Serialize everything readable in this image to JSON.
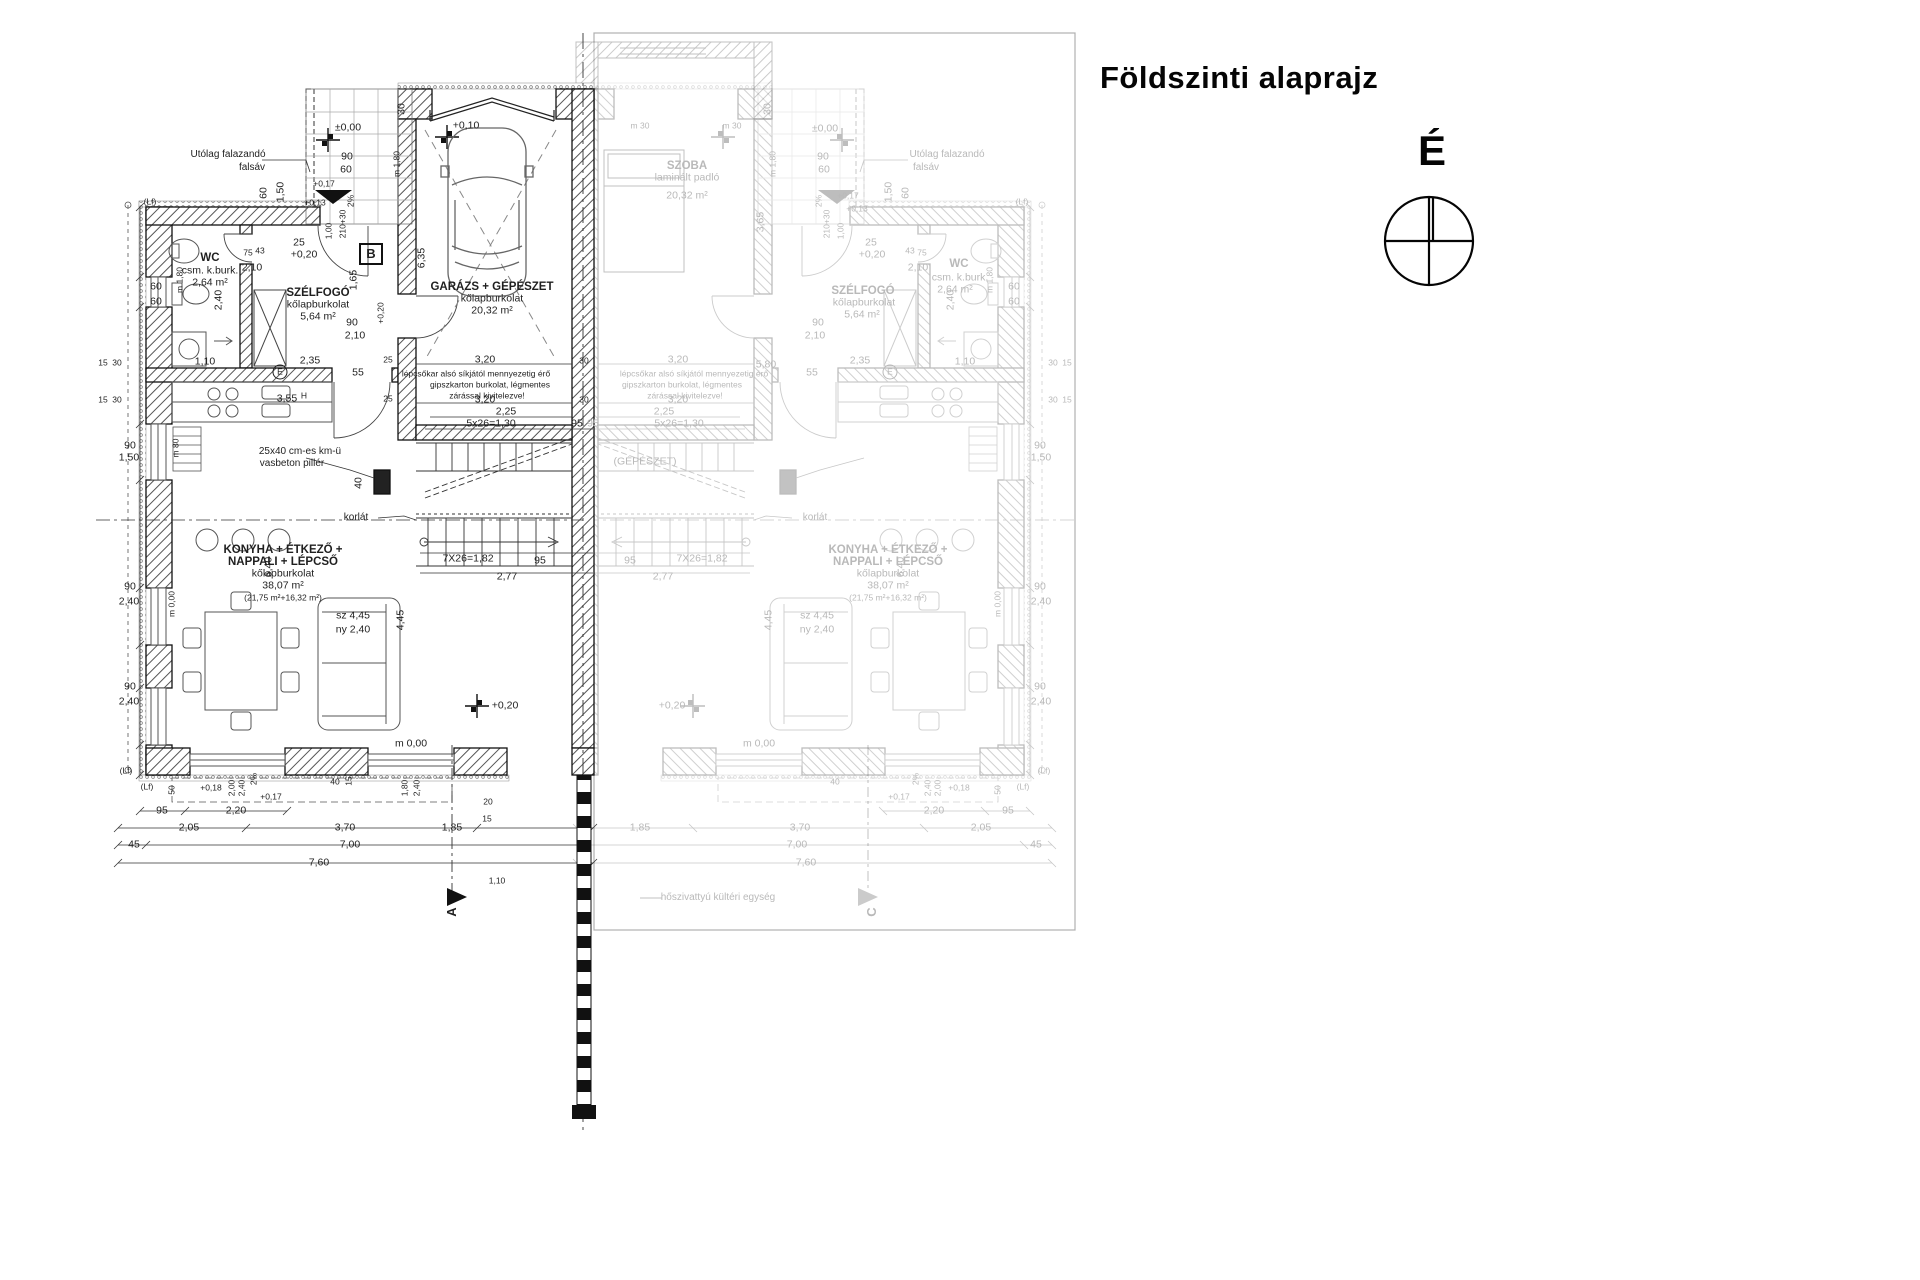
{
  "title": "Földszinti alaprajz",
  "north": {
    "label": "É"
  },
  "colors": {
    "ink": "#1f1f1f",
    "faded": "#b9b9b9",
    "paper": "#ffffff"
  },
  "rooms_left_unit": [
    {
      "name": "WC",
      "finish": "csm. k.burk.",
      "area": "2,64 m²"
    },
    {
      "name": "SZÉLFOGÓ",
      "finish": "kőlapburkolat",
      "area": "5,64 m²"
    },
    {
      "name": "GARÁZS + GÉPÉSZET",
      "finish": "kőlapburkolat",
      "area": "20,32 m²"
    },
    {
      "name": "KONYHA + ÉTKEZŐ + NAPPALI + LÉPCSŐ",
      "finish": "kőlapburkolat",
      "area": "38,07 m² (21,75 m²+16,32 m²)"
    }
  ],
  "rooms_right_unit_faded": [
    {
      "name": "SZOBA",
      "finish": "laminált padló",
      "area": "20,32 m²"
    },
    {
      "name": "WC",
      "finish": "csm. k.burk.",
      "area": "2,64 m²"
    },
    {
      "name": "SZÉLFOGÓ",
      "finish": "kőlapburkolat",
      "area": "5,64 m²"
    },
    {
      "name": "KONYHA + ÉTKEZŐ + NAPPALI + LÉPCSŐ",
      "finish": "kőlapburkolat",
      "area": "38,07 m² (21,75 m²+16,32 m²)"
    }
  ],
  "annotations": [
    {
      "n": "room-label-wc",
      "t": "WC",
      "x": 210,
      "y": 258,
      "c": "rm"
    },
    {
      "n": "room-finish-wc",
      "t": "csm. k.burk.",
      "x": 210,
      "y": 271,
      "c": "sub"
    },
    {
      "n": "room-area-wc",
      "t": "2,64 m²",
      "x": 210,
      "y": 283,
      "c": "sub"
    },
    {
      "n": "room-label-szelfogo",
      "t": "SZÉLFOGÓ",
      "x": 318,
      "y": 293,
      "c": "rm"
    },
    {
      "n": "room-finish-szelfogo",
      "t": "kőlapburkolat",
      "x": 318,
      "y": 305,
      "c": "sub"
    },
    {
      "n": "room-area-szelfogo",
      "t": "5,64 m²",
      "x": 318,
      "y": 317,
      "c": "sub"
    },
    {
      "n": "room-label-garazs",
      "t": "GARÁZS + GÉPÉSZET",
      "x": 492,
      "y": 287,
      "c": "rm"
    },
    {
      "n": "room-finish-garazs",
      "t": "kőlapburkolat",
      "x": 492,
      "y": 299,
      "c": "sub"
    },
    {
      "n": "room-area-garazs",
      "t": "20,32 m²",
      "x": 492,
      "y": 311,
      "c": "sub"
    },
    {
      "n": "room-label-konyha",
      "t": "KONYHA + ÉTKEZŐ +",
      "x": 283,
      "y": 550,
      "c": "rm"
    },
    {
      "n": "room-label-konyha2",
      "t": "NAPPALI + LÉPCSŐ",
      "x": 283,
      "y": 562,
      "c": "rm"
    },
    {
      "n": "room-finish-konyha",
      "t": "kőlapburkolat",
      "x": 283,
      "y": 574,
      "c": "sub"
    },
    {
      "n": "room-area-konyha",
      "t": "38,07 m²",
      "x": 283,
      "y": 586,
      "c": "sub"
    },
    {
      "n": "room-area-konyha2",
      "t": "(21,75 m²+16,32 m²)",
      "x": 283,
      "y": 598,
      "c": "tiny"
    },
    {
      "n": "note-falsav-1",
      "t": "Utólag falazandó",
      "x": 228,
      "y": 155,
      "c": "note"
    },
    {
      "n": "note-falsav-2",
      "t": "falsáv",
      "x": 252,
      "y": 168,
      "c": "note"
    },
    {
      "n": "note-pillar-1",
      "t": "25x40 cm-es km-ü",
      "x": 300,
      "y": 452,
      "c": "note"
    },
    {
      "n": "note-pillar-2",
      "t": "vasbeton pillér",
      "x": 292,
      "y": 464,
      "c": "note"
    },
    {
      "n": "note-gipszkarton-1",
      "t": "lépcsőkar alsó síkjától mennyezetig érő",
      "x": 476,
      "y": 374,
      "c": "tiny"
    },
    {
      "n": "note-gipszkarton-2",
      "t": "gipszkarton burkolat, légmentes",
      "x": 490,
      "y": 385,
      "c": "tiny"
    },
    {
      "n": "note-gipszkarton-3",
      "t": "zárással kivitelezve!",
      "x": 487,
      "y": 396,
      "c": "tiny"
    },
    {
      "n": "note-korlat",
      "t": "korlát",
      "x": 356,
      "y": 518,
      "c": "note"
    },
    {
      "t": "3,55",
      "x": 287,
      "y": 399
    },
    {
      "t": "H",
      "x": 304,
      "y": 396,
      "c": "tiny"
    },
    {
      "n": "level-porch",
      "t": "±0,00",
      "x": 348,
      "y": 128
    },
    {
      "n": "level-garage",
      "t": "+0,10",
      "x": 466,
      "y": 126
    },
    {
      "n": "level-szelfogo",
      "t": "+0,20",
      "x": 304,
      "y": 255
    },
    {
      "n": "level-living",
      "t": "+0,20",
      "x": 505,
      "y": 706
    },
    {
      "n": "level-terrace",
      "t": "m 0,00",
      "x": 411,
      "y": 744
    },
    {
      "t": "90",
      "x": 347,
      "y": 157
    },
    {
      "t": "60",
      "x": 346,
      "y": 170
    },
    {
      "t": "(Lf)",
      "x": 150,
      "y": 202,
      "c": "tiny"
    },
    {
      "t": "60",
      "x": 264,
      "y": 193,
      "r": -90
    },
    {
      "t": "1,50",
      "x": 281,
      "y": 192,
      "r": -90
    },
    {
      "t": "m 1,80",
      "x": 397,
      "y": 164,
      "r": -90,
      "c": "tiny"
    },
    {
      "t": "30",
      "x": 402,
      "y": 109,
      "r": -90
    },
    {
      "t": "2%",
      "x": 351,
      "y": 201,
      "r": -90,
      "c": "tiny"
    },
    {
      "t": "210+30",
      "x": 343,
      "y": 224,
      "r": -90,
      "c": "tiny"
    },
    {
      "t": "1,00",
      "x": 329,
      "y": 231,
      "r": -90,
      "c": "tiny"
    },
    {
      "t": "25",
      "x": 299,
      "y": 243
    },
    {
      "t": "+0,17",
      "x": 324,
      "y": 184,
      "c": "tiny"
    },
    {
      "t": "+0,13",
      "x": 315,
      "y": 203,
      "c": "tiny"
    },
    {
      "t": "60",
      "x": 156,
      "y": 287
    },
    {
      "t": "60",
      "x": 156,
      "y": 302
    },
    {
      "t": "75",
      "x": 248,
      "y": 253,
      "c": "tiny"
    },
    {
      "t": "43",
      "x": 260,
      "y": 251,
      "c": "tiny"
    },
    {
      "t": "2,10",
      "x": 252,
      "y": 268
    },
    {
      "t": "1,65",
      "x": 354,
      "y": 280,
      "r": -90
    },
    {
      "t": "2,40",
      "x": 219,
      "y": 300,
      "r": -90
    },
    {
      "t": "m 1,80",
      "x": 180,
      "y": 280,
      "r": -90,
      "c": "tiny"
    },
    {
      "t": "90",
      "x": 352,
      "y": 323
    },
    {
      "t": "2,10",
      "x": 355,
      "y": 336
    },
    {
      "t": "55",
      "x": 358,
      "y": 373
    },
    {
      "t": "2,35",
      "x": 310,
      "y": 361
    },
    {
      "t": "1,10",
      "x": 205,
      "y": 362
    },
    {
      "t": "15",
      "x": 103,
      "y": 363,
      "c": "tiny"
    },
    {
      "t": "30",
      "x": 117,
      "y": 363,
      "c": "tiny"
    },
    {
      "t": "15",
      "x": 103,
      "y": 400,
      "c": "tiny"
    },
    {
      "t": "30",
      "x": 117,
      "y": 400,
      "c": "tiny"
    },
    {
      "n": "symbol-e",
      "t": "E",
      "x": 280,
      "y": 372,
      "c": "circ"
    },
    {
      "t": "90",
      "x": 130,
      "y": 446
    },
    {
      "t": "1,50",
      "x": 129,
      "y": 458
    },
    {
      "t": "90",
      "x": 130,
      "y": 587
    },
    {
      "t": "2,40",
      "x": 129,
      "y": 602
    },
    {
      "t": "90",
      "x": 130,
      "y": 687
    },
    {
      "t": "2,40",
      "x": 129,
      "y": 702
    },
    {
      "t": "m 0,00",
      "x": 172,
      "y": 604,
      "r": -90,
      "c": "tiny"
    },
    {
      "t": "m 80",
      "x": 176,
      "y": 448,
      "r": -90,
      "c": "tiny"
    },
    {
      "t": "6,35",
      "x": 422,
      "y": 258,
      "r": -90
    },
    {
      "t": "+0,20",
      "x": 381,
      "y": 313,
      "r": -90,
      "c": "tiny"
    },
    {
      "t": "3,20",
      "x": 485,
      "y": 360
    },
    {
      "t": "3,20",
      "x": 485,
      "y": 400
    },
    {
      "t": "2,25",
      "x": 506,
      "y": 412
    },
    {
      "t": "5x26=1,30",
      "x": 491,
      "y": 424
    },
    {
      "t": "95",
      "x": 577,
      "y": 424
    },
    {
      "t": "7X26=1,82",
      "x": 468,
      "y": 559
    },
    {
      "t": "95",
      "x": 540,
      "y": 561
    },
    {
      "t": "2,77",
      "x": 507,
      "y": 577
    },
    {
      "t": "40",
      "x": 359,
      "y": 483,
      "r": -90
    },
    {
      "t": "6,40",
      "x": 269,
      "y": 567,
      "r": -90
    },
    {
      "t": "sz  4,45",
      "x": 353,
      "y": 616
    },
    {
      "t": "ny  2,40",
      "x": 353,
      "y": 630
    },
    {
      "t": "4,45",
      "x": 401,
      "y": 620,
      "r": -90
    },
    {
      "t": "(Lf)",
      "x": 126,
      "y": 771,
      "c": "tiny"
    },
    {
      "t": "(Lf)",
      "x": 147,
      "y": 787,
      "c": "tiny"
    },
    {
      "t": "50",
      "x": 172,
      "y": 790,
      "r": -90,
      "c": "tiny"
    },
    {
      "t": "+0,18",
      "x": 211,
      "y": 788,
      "c": "tiny"
    },
    {
      "t": "2,00",
      "x": 232,
      "y": 788,
      "r": -90,
      "c": "tiny"
    },
    {
      "t": "2,40",
      "x": 242,
      "y": 788,
      "r": -90,
      "c": "tiny"
    },
    {
      "t": "2%",
      "x": 254,
      "y": 779,
      "r": -90,
      "c": "tiny"
    },
    {
      "t": "+0,17",
      "x": 271,
      "y": 797,
      "c": "tiny"
    },
    {
      "t": "40",
      "x": 335,
      "y": 782,
      "c": "tiny"
    },
    {
      "t": "15",
      "x": 349,
      "y": 781,
      "r": -90,
      "c": "tiny"
    },
    {
      "t": "1,80",
      "x": 405,
      "y": 788,
      "r": -90,
      "c": "tiny"
    },
    {
      "t": "2,40",
      "x": 417,
      "y": 788,
      "r": -90,
      "c": "tiny"
    },
    {
      "t": "20",
      "x": 488,
      "y": 802,
      "c": "tiny"
    },
    {
      "t": "15",
      "x": 487,
      "y": 819,
      "c": "tiny"
    },
    {
      "t": "95",
      "x": 162,
      "y": 811
    },
    {
      "t": "2,20",
      "x": 236,
      "y": 811
    },
    {
      "t": "2,05",
      "x": 189,
      "y": 828
    },
    {
      "t": "3,70",
      "x": 345,
      "y": 828
    },
    {
      "t": "1,85",
      "x": 452,
      "y": 828
    },
    {
      "t": "45",
      "x": 134,
      "y": 845
    },
    {
      "t": "7,00",
      "x": 350,
      "y": 845
    },
    {
      "t": "7,60",
      "x": 319,
      "y": 863
    },
    {
      "n": "section-a",
      "t": "A",
      "x": 452,
      "y": 912,
      "r": -90,
      "c": "sec"
    },
    {
      "t": "1,10",
      "x": 497,
      "y": 881,
      "c": "tiny"
    },
    {
      "t": "25",
      "x": 388,
      "y": 360,
      "c": "tiny"
    },
    {
      "t": "25",
      "x": 388,
      "y": 399,
      "c": "tiny"
    },
    {
      "t": "30",
      "x": 584,
      "y": 361,
      "c": "tiny"
    },
    {
      "t": "30",
      "x": 584,
      "y": 400,
      "c": "tiny"
    },
    {
      "n": "section-b",
      "t": "B",
      "x": 371,
      "y": 254,
      "c": "sec"
    },
    {
      "n": "room-label-szoba",
      "t": "SZOBA",
      "x": 687,
      "y": 166,
      "c": "rm",
      "f": 1
    },
    {
      "n": "room-finish-szoba",
      "t": "laminált padló",
      "x": 687,
      "y": 178,
      "f": 1
    },
    {
      "n": "room-area-szoba",
      "t": "20,32 m²",
      "x": 687,
      "y": 196,
      "f": 1
    },
    {
      "t": "Utólag falazandó",
      "x": 947,
      "y": 155,
      "c": "note",
      "f": 1
    },
    {
      "t": "falsáv",
      "x": 926,
      "y": 168,
      "c": "note",
      "f": 1
    },
    {
      "t": "SZÉLFOGÓ",
      "x": 863,
      "y": 291,
      "c": "rm",
      "f": 1
    },
    {
      "t": "kőlapburkolat",
      "x": 864,
      "y": 303,
      "f": 1
    },
    {
      "t": "5,64 m²",
      "x": 862,
      "y": 315,
      "f": 1
    },
    {
      "t": "WC",
      "x": 959,
      "y": 264,
      "c": "rm",
      "f": 1
    },
    {
      "t": "csm. k.burk.",
      "x": 960,
      "y": 278,
      "f": 1
    },
    {
      "t": "2,64 m²",
      "x": 955,
      "y": 290,
      "f": 1
    },
    {
      "t": "KONYHA + ÉTKEZŐ +",
      "x": 888,
      "y": 550,
      "c": "rm",
      "f": 1
    },
    {
      "t": "NAPPALI + LÉPCSŐ",
      "x": 888,
      "y": 562,
      "c": "rm",
      "f": 1
    },
    {
      "t": "kőlapburkolat",
      "x": 888,
      "y": 574,
      "f": 1
    },
    {
      "t": "38,07 m²",
      "x": 888,
      "y": 586,
      "f": 1
    },
    {
      "t": "(21,75 m²+16,32 m²)",
      "x": 888,
      "y": 598,
      "c": "tiny",
      "f": 1
    },
    {
      "t": "(GÉPÉSZET)",
      "x": 645,
      "y": 462,
      "f": 1
    },
    {
      "n": "note-heatpump",
      "t": "hőszivattyú kültéri egység",
      "x": 718,
      "y": 898,
      "c": "note",
      "f": 1
    },
    {
      "t": "lépcsőkar alsó síkjától mennyezetig érő",
      "x": 694,
      "y": 374,
      "c": "tiny",
      "f": 1
    },
    {
      "t": "gipszkarton burkolat, légmentes",
      "x": 682,
      "y": 385,
      "c": "tiny",
      "f": 1
    },
    {
      "t": "zárással kivitelezve!",
      "x": 685,
      "y": 396,
      "c": "tiny",
      "f": 1
    },
    {
      "t": "korlát",
      "x": 815,
      "y": 518,
      "c": "note",
      "f": 1
    },
    {
      "t": "+0,20",
      "x": 872,
      "y": 255,
      "f": 1
    },
    {
      "t": "+0,20",
      "x": 672,
      "y": 706,
      "f": 1
    },
    {
      "t": "±0,00",
      "x": 825,
      "y": 129,
      "f": 1
    },
    {
      "t": "m 0,00",
      "x": 759,
      "y": 744,
      "f": 1
    },
    {
      "t": "2,25",
      "x": 664,
      "y": 412,
      "f": 1
    },
    {
      "t": "5x26=1,30",
      "x": 679,
      "y": 424,
      "f": 1
    },
    {
      "t": "95",
      "x": 593,
      "y": 424,
      "f": 1
    },
    {
      "t": "7X26=1,82",
      "x": 702,
      "y": 559,
      "f": 1
    },
    {
      "t": "95",
      "x": 630,
      "y": 561,
      "f": 1
    },
    {
      "t": "2,77",
      "x": 663,
      "y": 577,
      "f": 1
    },
    {
      "t": "5,80",
      "x": 766,
      "y": 365,
      "f": 1
    },
    {
      "t": "3,65",
      "x": 761,
      "y": 222,
      "r": -90,
      "f": 1
    },
    {
      "t": "m 30",
      "x": 640,
      "y": 126,
      "c": "tiny",
      "f": 1
    },
    {
      "t": "m 30",
      "x": 732,
      "y": 126,
      "c": "tiny",
      "f": 1
    },
    {
      "t": "3,20",
      "x": 678,
      "y": 360,
      "f": 1
    },
    {
      "t": "3,20",
      "x": 678,
      "y": 400,
      "f": 1
    },
    {
      "t": "1,85",
      "x": 640,
      "y": 828,
      "f": 1
    },
    {
      "t": "3,70",
      "x": 800,
      "y": 828,
      "f": 1
    },
    {
      "t": "2,05",
      "x": 981,
      "y": 828,
      "f": 1
    },
    {
      "t": "95",
      "x": 1008,
      "y": 811,
      "f": 1
    },
    {
      "t": "2,20",
      "x": 934,
      "y": 811,
      "f": 1
    },
    {
      "t": "45",
      "x": 1036,
      "y": 845,
      "f": 1
    },
    {
      "t": "7,00",
      "x": 797,
      "y": 845,
      "f": 1
    },
    {
      "t": "7,60",
      "x": 806,
      "y": 863,
      "f": 1
    },
    {
      "t": "+0,17",
      "x": 899,
      "y": 797,
      "c": "tiny",
      "f": 1
    },
    {
      "t": "+0,18",
      "x": 959,
      "y": 788,
      "c": "tiny",
      "f": 1
    },
    {
      "t": "(Lf)",
      "x": 1044,
      "y": 771,
      "c": "tiny",
      "f": 1
    },
    {
      "t": "(Lf)",
      "x": 1023,
      "y": 787,
      "c": "tiny",
      "f": 1
    },
    {
      "t": "50",
      "x": 998,
      "y": 790,
      "r": -90,
      "c": "tiny",
      "f": 1
    },
    {
      "t": "2,00",
      "x": 938,
      "y": 788,
      "r": -90,
      "c": "tiny",
      "f": 1
    },
    {
      "t": "2,40",
      "x": 928,
      "y": 788,
      "r": -90,
      "c": "tiny",
      "f": 1
    },
    {
      "t": "2%",
      "x": 916,
      "y": 779,
      "r": -90,
      "c": "tiny",
      "f": 1
    },
    {
      "t": "40",
      "x": 835,
      "y": 782,
      "c": "tiny",
      "f": 1
    },
    {
      "t": "m 0,00",
      "x": 998,
      "y": 604,
      "r": -90,
      "c": "tiny",
      "f": 1
    },
    {
      "t": "90",
      "x": 1040,
      "y": 446,
      "f": 1
    },
    {
      "t": "1,50",
      "x": 1041,
      "y": 458,
      "f": 1
    },
    {
      "t": "90",
      "x": 1040,
      "y": 587,
      "f": 1
    },
    {
      "t": "2,40",
      "x": 1041,
      "y": 602,
      "f": 1
    },
    {
      "t": "90",
      "x": 1040,
      "y": 687,
      "f": 1
    },
    {
      "t": "2,40",
      "x": 1041,
      "y": 702,
      "f": 1
    },
    {
      "t": "60",
      "x": 1014,
      "y": 287,
      "f": 1
    },
    {
      "t": "60",
      "x": 1014,
      "y": 302,
      "f": 1
    },
    {
      "t": "15",
      "x": 1067,
      "y": 363,
      "c": "tiny",
      "f": 1
    },
    {
      "t": "30",
      "x": 1053,
      "y": 363,
      "c": "tiny",
      "f": 1
    },
    {
      "t": "15",
      "x": 1067,
      "y": 400,
      "c": "tiny",
      "f": 1
    },
    {
      "t": "30",
      "x": 1053,
      "y": 400,
      "c": "tiny",
      "f": 1
    },
    {
      "t": "1,10",
      "x": 965,
      "y": 362,
      "f": 1
    },
    {
      "t": "2,40",
      "x": 951,
      "y": 300,
      "r": -90,
      "f": 1
    },
    {
      "t": "m 1,80",
      "x": 990,
      "y": 280,
      "r": -90,
      "c": "tiny",
      "f": 1
    },
    {
      "t": "2,10",
      "x": 918,
      "y": 268,
      "f": 1
    },
    {
      "t": "75",
      "x": 922,
      "y": 253,
      "c": "tiny",
      "f": 1
    },
    {
      "t": "43",
      "x": 910,
      "y": 251,
      "c": "tiny",
      "f": 1
    },
    {
      "t": "25",
      "x": 871,
      "y": 243,
      "f": 1
    },
    {
      "t": "90",
      "x": 823,
      "y": 157,
      "f": 1
    },
    {
      "t": "60",
      "x": 824,
      "y": 170,
      "f": 1
    },
    {
      "t": "210+30",
      "x": 827,
      "y": 224,
      "r": -90,
      "c": "tiny",
      "f": 1
    },
    {
      "t": "1,00",
      "x": 841,
      "y": 231,
      "r": -90,
      "c": "tiny",
      "f": 1
    },
    {
      "t": "2%",
      "x": 819,
      "y": 201,
      "r": -90,
      "c": "tiny",
      "f": 1
    },
    {
      "t": "1,50",
      "x": 889,
      "y": 192,
      "r": -90,
      "f": 1
    },
    {
      "t": "60",
      "x": 906,
      "y": 193,
      "r": -90,
      "f": 1
    },
    {
      "t": "m 1,80",
      "x": 773,
      "y": 164,
      "r": -90,
      "c": "tiny",
      "f": 1
    },
    {
      "t": "30",
      "x": 768,
      "y": 109,
      "r": -90,
      "f": 1
    },
    {
      "t": "(Lf)",
      "x": 1022,
      "y": 202,
      "c": "tiny",
      "f": 1
    },
    {
      "t": "90",
      "x": 818,
      "y": 323,
      "f": 1
    },
    {
      "t": "2,10",
      "x": 815,
      "y": 336,
      "f": 1
    },
    {
      "t": "55",
      "x": 812,
      "y": 373,
      "f": 1
    },
    {
      "t": "2,35",
      "x": 860,
      "y": 361,
      "f": 1
    },
    {
      "n": "symbol-e-faded",
      "t": "E",
      "x": 890,
      "y": 372,
      "c": "circ",
      "f": 1
    },
    {
      "n": "section-c",
      "t": "C",
      "x": 872,
      "y": 912,
      "r": -90,
      "c": "sec",
      "f": 1
    },
    {
      "t": "6,40",
      "x": 901,
      "y": 567,
      "r": -90,
      "f": 1
    },
    {
      "t": "4,45",
      "x": 769,
      "y": 620,
      "r": -90,
      "f": 1
    },
    {
      "t": "sz  4,45",
      "x": 817,
      "y": 616,
      "f": 1
    },
    {
      "t": "ny  2,40",
      "x": 817,
      "y": 630,
      "f": 1
    },
    {
      "t": "+0,17",
      "x": 848,
      "y": 196,
      "c": "tiny",
      "f": 1
    },
    {
      "t": "+0,13",
      "x": 857,
      "y": 209,
      "c": "tiny",
      "f": 1
    }
  ]
}
